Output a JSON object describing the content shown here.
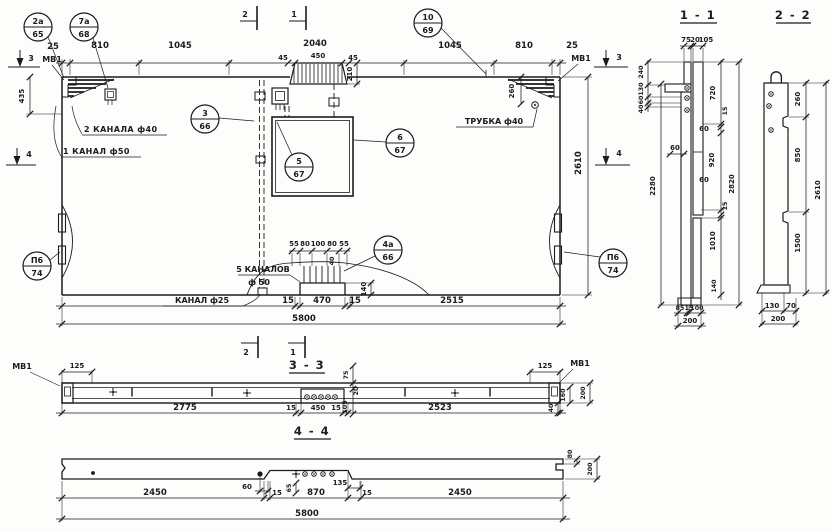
{
  "plan": {
    "markers": {
      "m1": "1",
      "m2": "2",
      "m3": "3",
      "m4": "4"
    },
    "labels": {
      "mv1": "МВ1",
      "channels2": "2 КАНАЛА ф40",
      "channel1": "1 КАНАЛ ф50",
      "tube": "ТРУБКА ф40",
      "channels5_line1": "5 КАНАЛОВ",
      "channels5_line2": "ф 50",
      "channel25": "КАНАЛ ф25"
    },
    "callouts": {
      "c2a": {
        "num": "2а",
        "sheet": "65"
      },
      "c7a": {
        "num": "7а",
        "sheet": "68"
      },
      "c10": {
        "num": "10",
        "sheet": "69"
      },
      "c3": {
        "num": "3",
        "sheet": "66"
      },
      "c5": {
        "num": "5",
        "sheet": "67"
      },
      "c6": {
        "num": "6",
        "sheet": "67"
      },
      "c4a": {
        "num": "4а",
        "sheet": "66"
      },
      "p6": {
        "num": "П6",
        "sheet": "74"
      }
    },
    "dims": {
      "d25": "25",
      "d810": "810",
      "d1045": "1045",
      "d2040": "2040",
      "d45": "45",
      "d450": "450",
      "d210": "210",
      "d435": "435",
      "d260": "260",
      "d2610": "2610",
      "c55": "55",
      "c80": "80",
      "c100": "100",
      "d40": "40",
      "d140": "140",
      "d15": "15",
      "d470": "470",
      "d2515": "2515",
      "d5800": "5800"
    }
  },
  "s11": {
    "title": "1 - 1",
    "d75": "75",
    "d20": "20",
    "d105": "105",
    "d240": "240",
    "d130": "130",
    "d60": "60",
    "d40": "40",
    "d720": "720",
    "d15": "15",
    "d920": "920",
    "d2280": "2280",
    "d2820": "2820",
    "d1010": "1010",
    "d140": "140",
    "d85": "85",
    "d100": "100",
    "d200": "200"
  },
  "s22": {
    "title": "2 - 2",
    "d260": "260",
    "d850": "850",
    "d1500": "1500",
    "d2610": "2610",
    "d130": "130",
    "d70": "70",
    "d200": "200"
  },
  "s33": {
    "title": "3 - 3",
    "mv1": "МВ1",
    "d125": "125",
    "d2775": "2775",
    "d15": "15",
    "d450": "450",
    "d75": "75",
    "d20": "20",
    "d105": "105",
    "d2523": "2523",
    "d160": "160",
    "d200": "200",
    "d40": "40"
  },
  "s44": {
    "title": "4 - 4",
    "d2450": "2450",
    "d60": "60",
    "d15": "15",
    "d65": "65",
    "d870": "870",
    "d135": "135",
    "d80": "80",
    "d200": "200",
    "d5800": "5800"
  }
}
